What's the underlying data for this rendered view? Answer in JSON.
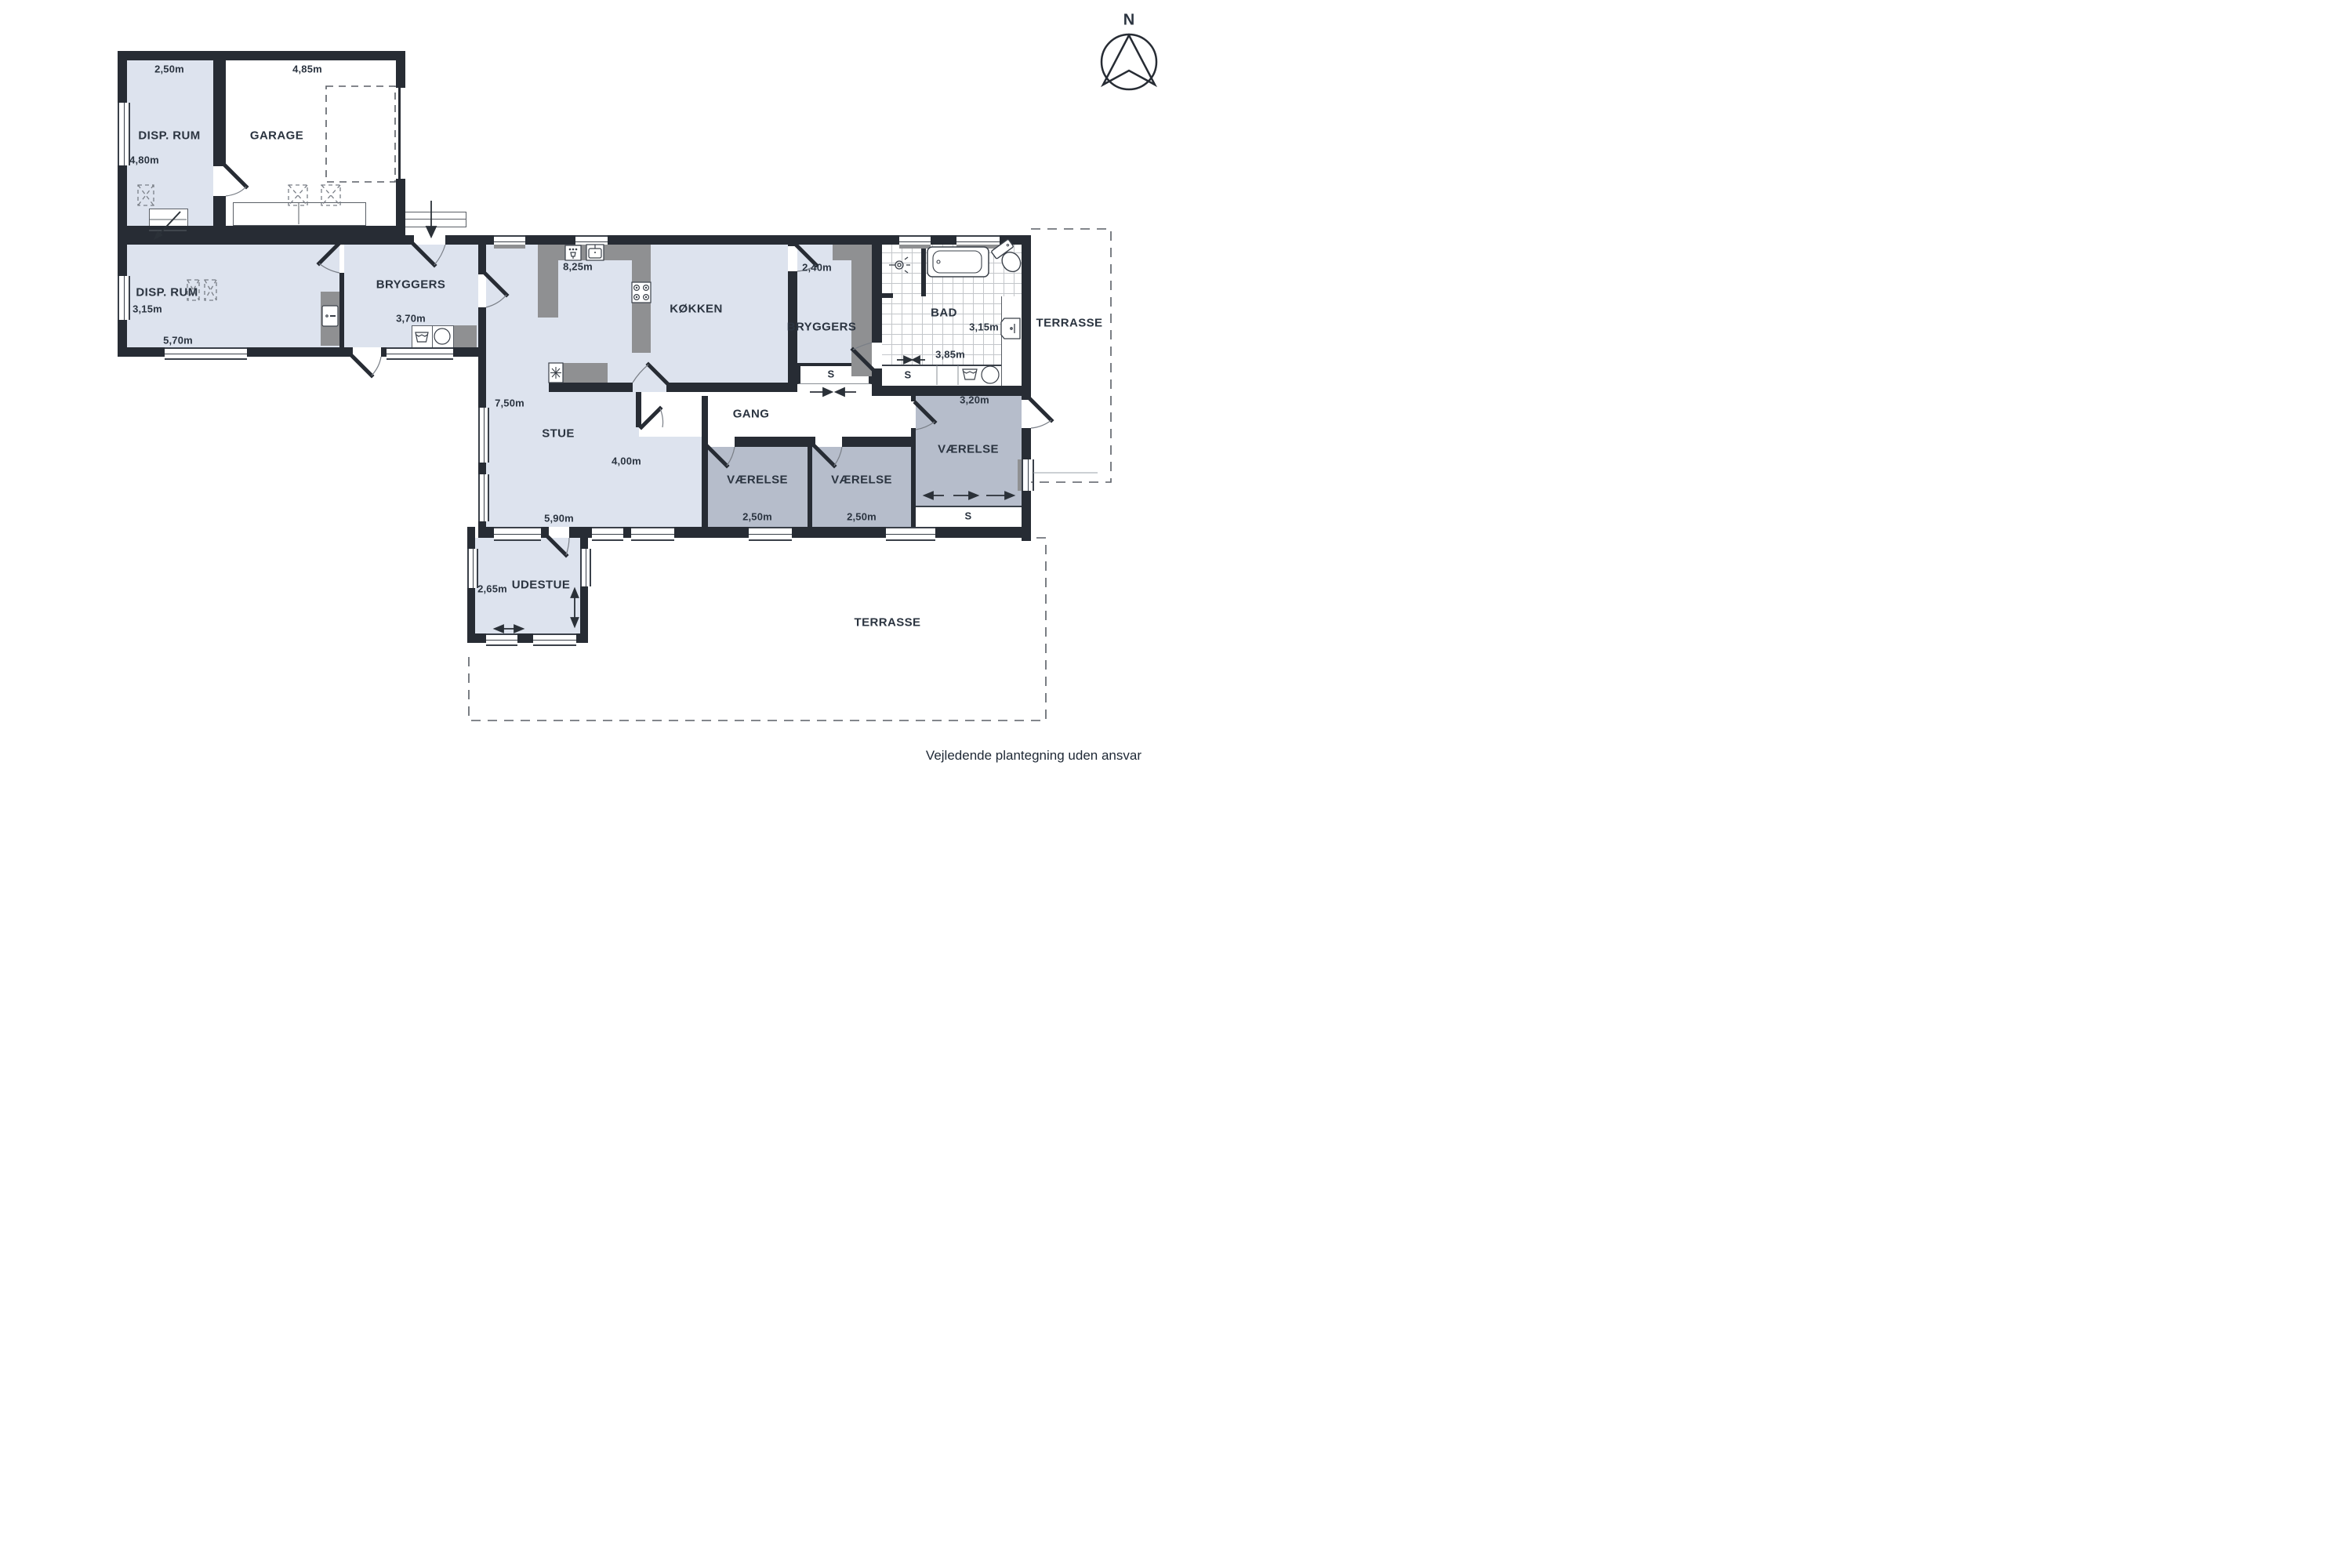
{
  "compass": {
    "north_label": "N"
  },
  "footer": {
    "disclaimer": "Vejledende plantegning uden ansvar"
  },
  "colors": {
    "wall": "#272c34",
    "room_light": "#dde3ee",
    "room_gray": "#b6bdcb",
    "counter": "#8f9092"
  },
  "rooms": {
    "disp_rum_garage": {
      "name": "DISP. RUM",
      "width": "2,50m",
      "depth": "4,80m"
    },
    "garage": {
      "name": "GARAGE",
      "width": "4,85m"
    },
    "disp_rum_main": {
      "name": "DISP. RUM",
      "depth": "3,15m",
      "width": "5,70m"
    },
    "bryggers_west": {
      "name": "BRYGGERS",
      "width": "3,70m"
    },
    "kokken": {
      "name": "KØKKEN",
      "width": "8,25m"
    },
    "bryggers_east": {
      "name": "BRYGGERS",
      "width": "2,40m"
    },
    "bad": {
      "name": "BAD",
      "width": "3,85m",
      "depth": "3,15m"
    },
    "gang": {
      "name": "GANG"
    },
    "stue": {
      "name": "STUE",
      "depth": "7,50m",
      "width": "5,90m",
      "east_width": "4,00m"
    },
    "vaerelse_1": {
      "name": "VÆRELSE",
      "width": "2,50m"
    },
    "vaerelse_2": {
      "name": "VÆRELSE",
      "width": "2,50m"
    },
    "vaerelse_3": {
      "name": "VÆRELSE",
      "width": "3,20m"
    },
    "udestue": {
      "name": "UDESTUE",
      "depth": "2,65m"
    },
    "terrasse_east": {
      "name": "TERRASSE"
    },
    "terrasse_south": {
      "name": "TERRASSE"
    }
  },
  "closets": {
    "gang": "S",
    "bad": "S",
    "vaerelse": "S"
  }
}
